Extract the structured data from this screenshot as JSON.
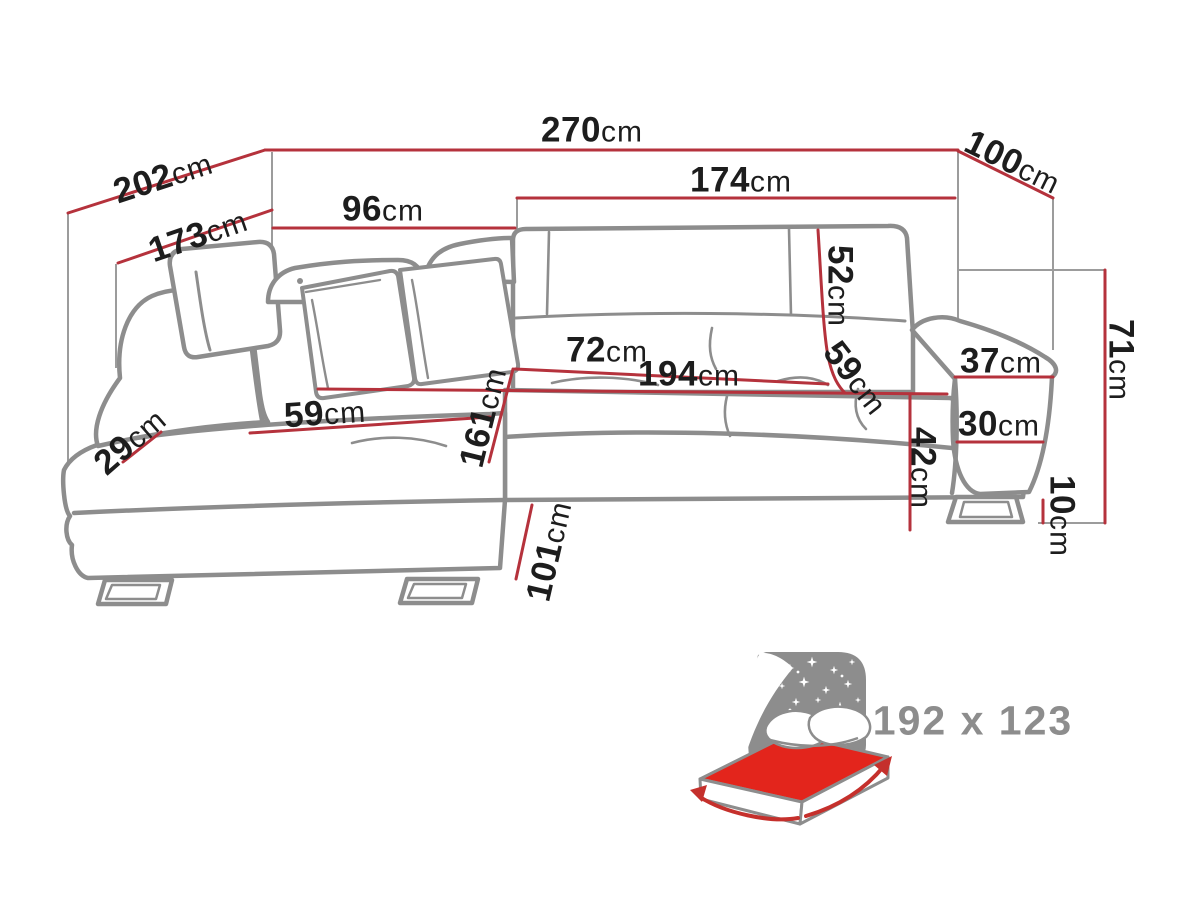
{
  "diagram_title": "corner-sofa-dimension-drawing",
  "dimensions": {
    "overall_width": {
      "value": "270",
      "unit": "cm"
    },
    "left_side_depth": {
      "value": "202",
      "unit": "cm"
    },
    "right_side_depth": {
      "value": "100",
      "unit": "cm"
    },
    "right_section_width": {
      "value": "174",
      "unit": "cm"
    },
    "chaise_top_width": {
      "value": "96",
      "unit": "cm"
    },
    "chaise_inner_length": {
      "value": "173",
      "unit": "cm"
    },
    "backrest_height": {
      "value": "52",
      "unit": "cm"
    },
    "seat_depth_right": {
      "value": "59",
      "unit": "cm"
    },
    "seat_depth_front": {
      "value": "72",
      "unit": "cm"
    },
    "seat_width_total": {
      "value": "194",
      "unit": "cm"
    },
    "armrest_top_width": {
      "value": "37",
      "unit": "cm"
    },
    "armrest_front_height": {
      "value": "30",
      "unit": "cm"
    },
    "seat_height": {
      "value": "42",
      "unit": "cm"
    },
    "leg_height": {
      "value": "10",
      "unit": "cm"
    },
    "total_height": {
      "value": "71",
      "unit": "cm"
    },
    "chaise_length": {
      "value": "161",
      "unit": "cm"
    },
    "chaise_seat_width": {
      "value": "59",
      "unit": "cm"
    },
    "front_corner_width": {
      "value": "29",
      "unit": "cm"
    },
    "chaise_outer_length": {
      "value": "101",
      "unit": "cm"
    }
  },
  "sleeping_area": {
    "label": "192 x 123"
  },
  "colors": {
    "dimension_red": "#b5323c",
    "drawing_gray": "#8d8d8d",
    "extension_gray": "#9c9c9c",
    "text_dark": "#1d1d1d",
    "icon_gray": "#8d8d8d",
    "mattress_red": "#e3251c",
    "arrow_red": "#c5302c"
  }
}
